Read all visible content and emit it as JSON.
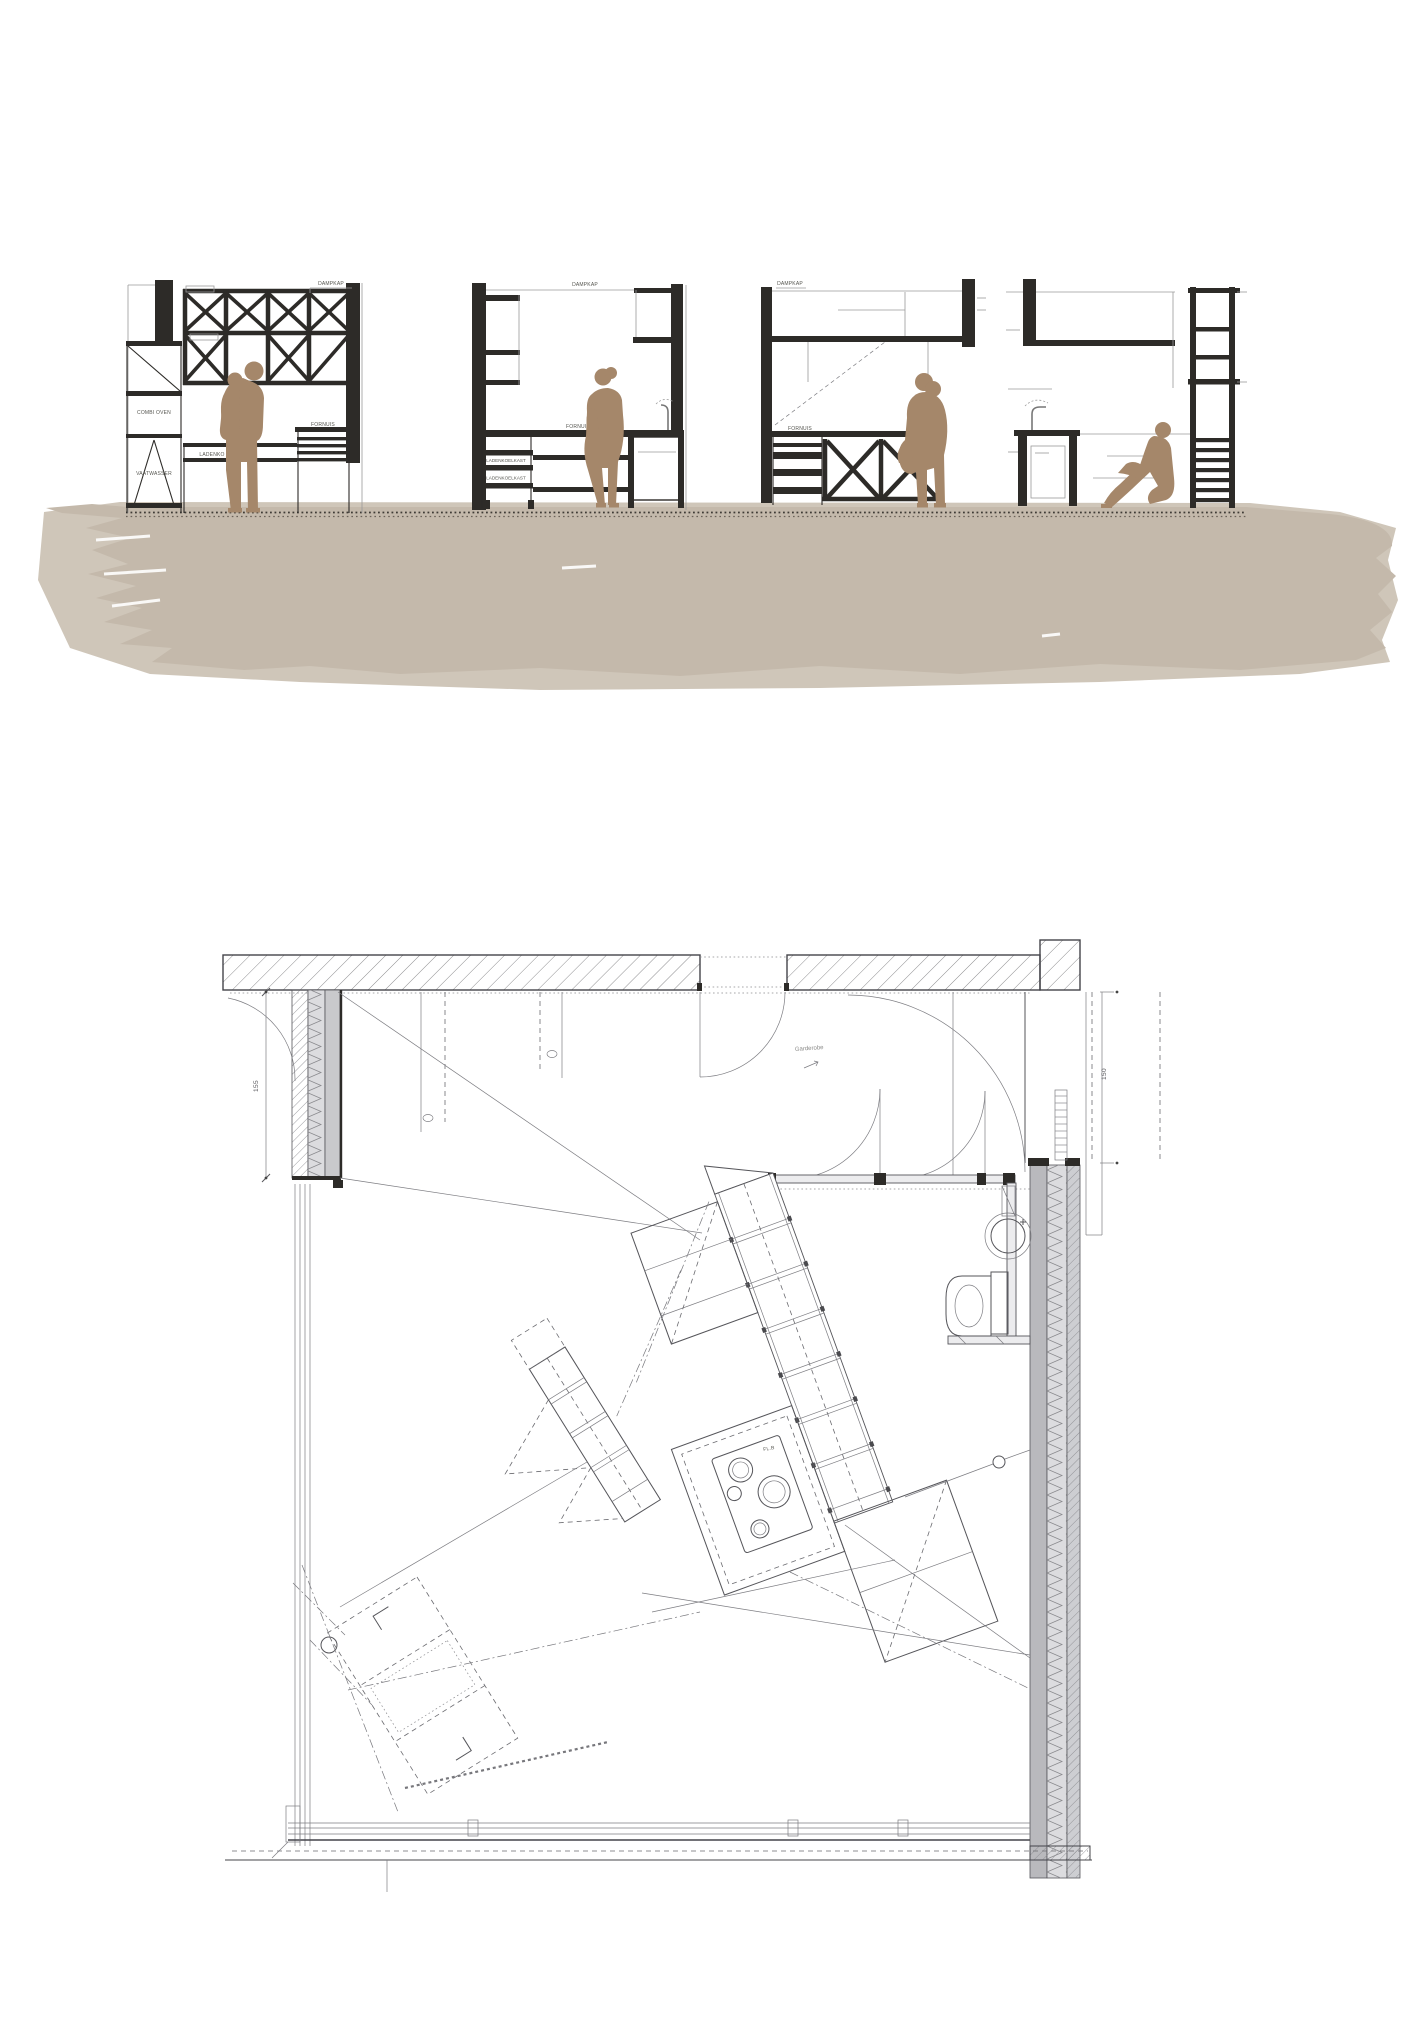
{
  "title": "architectural drawing — kitchen elevations and floor plan",
  "colors": {
    "ink": "#2d2b28",
    "thin_line": "#9a9a9a",
    "figure": "#a5876a",
    "ground": "#c4b9ab",
    "ground_light": "#cfc6b9",
    "wall_gray": "#b9b9bd"
  },
  "elevations": {
    "labels": {
      "dampkap_1": "DAMPKAP",
      "combi_oven": "COMBI OVEN",
      "vaatwasser": "VAATWASSER",
      "ladenkast": "LADENKO",
      "fornuis_1": "FORNUIS",
      "dampkap_2": "DAMPKAP",
      "fornuis_2": "FORNUIS",
      "ladenkoelkast_1": "LADENKOELKAST",
      "ladenkoelkast_2": "LADENKOELKAST",
      "dampkap_3": "DAMPKAP",
      "fornuis_3": "FORNUIS"
    }
  },
  "plan": {
    "dim_left": "155",
    "dim_right": "150",
    "annotation": "Garderobe",
    "cooktop_label": "FL.B"
  }
}
